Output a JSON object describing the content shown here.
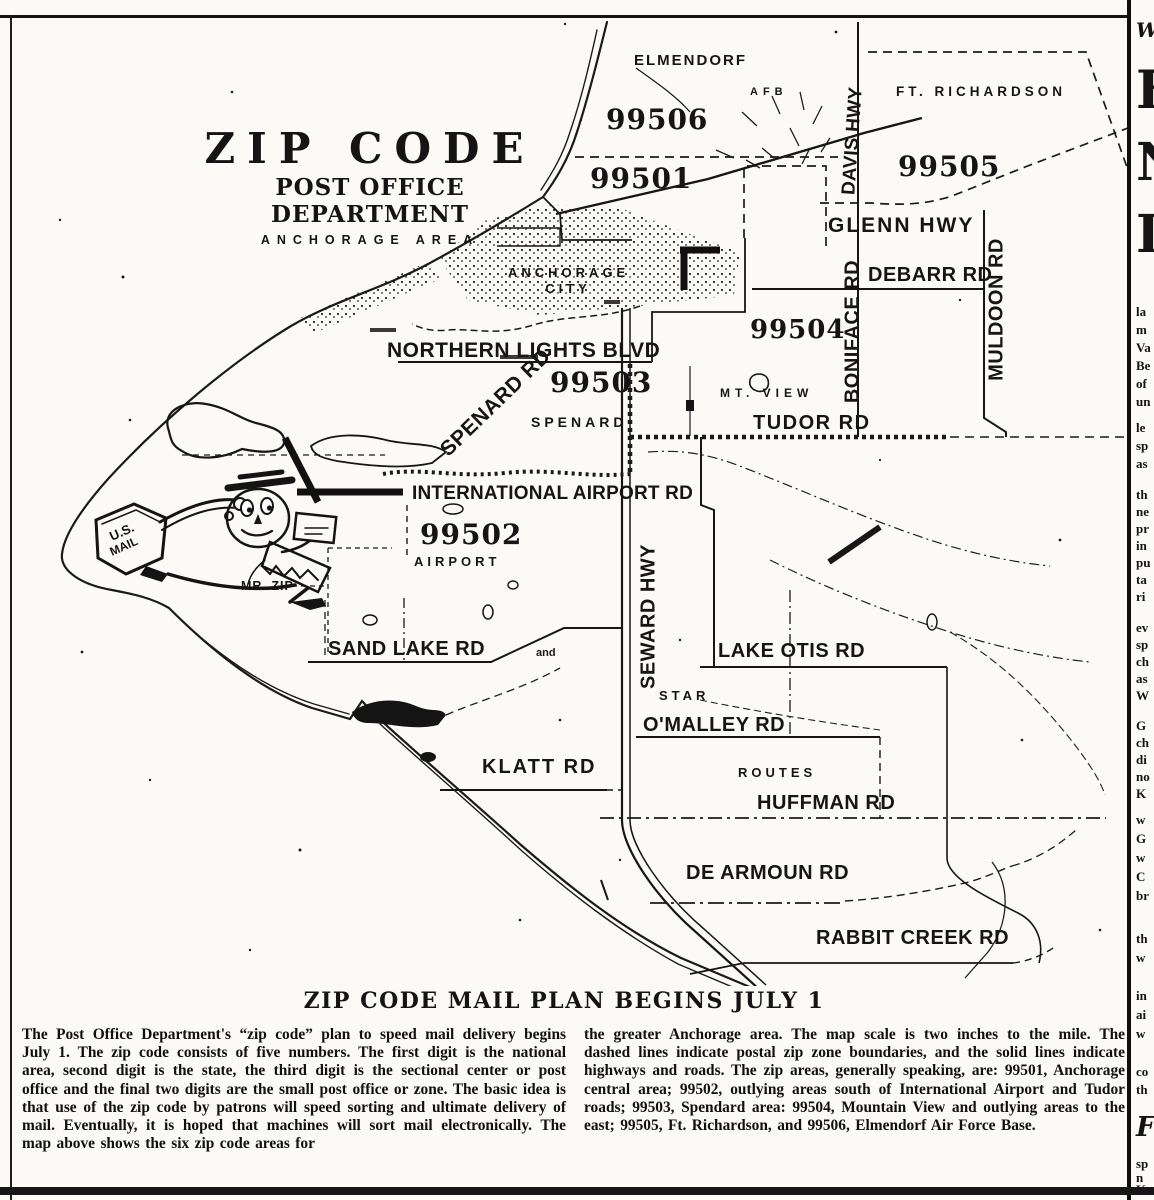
{
  "map": {
    "title": {
      "line1": "ZIP CODE",
      "line2": "POST OFFICE DEPARTMENT",
      "line3": "ANCHORAGE AREA"
    },
    "zips": {
      "z99506": "99506",
      "z99501": "99501",
      "z99505": "99505",
      "z99504": "99504",
      "z99503": "99503",
      "z99502": "99502"
    },
    "labels": {
      "elmendorf": "ELMENDORF",
      "afb": "AFB",
      "ft_richardson": "FT. RICHARDSON",
      "davis_hwy": "DAVIS HWY",
      "glenn_hwy": "GLENN HWY",
      "anchorage_city_line1": "ANCHORAGE",
      "anchorage_city_line2": "CITY",
      "debarr_rd": "DEBARR RD",
      "muldoon_rd": "MULDOON RD",
      "boniface_rd": "BONIFACE RD",
      "mt_view": "MT. VIEW",
      "northern_lights_blvd": "NORTHERN LIGHTS BLVD",
      "spenard_rd": "SPENARD RD",
      "spenard": "SPENARD",
      "tudor_rd": "TUDOR RD",
      "international_airport_rd": "INTERNATIONAL AIRPORT RD",
      "airport": "AIRPORT",
      "mr_zip": "MR. ZIP",
      "us_mail_line1": "U.S.",
      "us_mail_line2": "MAIL",
      "sand_lake_rd": "SAND LAKE RD",
      "and_connector": "and",
      "seward_hwy": "SEWARD HWY",
      "lake_otis_rd": "LAKE OTIS RD",
      "star": "STAR",
      "omalley_rd": "O'MALLEY RD",
      "klatt_rd": "KLATT RD",
      "routes": "ROUTES",
      "huffman_rd": "HUFFMAN RD",
      "de_armoun_rd": "DE ARMOUN RD",
      "rabbit_creek_rd": "RABBIT CREEK RD"
    }
  },
  "caption": {
    "heading": "ZIP CODE MAIL PLAN BEGINS JULY 1",
    "left_column": "The Post Office Department's “zip code” plan to speed mail delivery begins July 1. The zip code consists of five numbers. The first digit is the national area, second digit is the state, the third digit is the sectional center or post office and the final two digits are the small post office or zone. The basic idea is that use of the zip code by patrons will speed sorting and ultimate delivery of mail. Eventually, it is hoped that machines will sort mail electronically. The map above shows the six zip code areas for",
    "right_column": "the greater Anchorage area. The map scale is two inches to the mile. The dashed lines indicate postal zip zone boundaries, and the solid lines indicate highways and roads. The zip areas, generally speaking, are: 99501, Anchorage central area; 99502, outlying areas south of International Airport and Tudor roads; 99503, Spendard area: 99504, Mountain View and outlying areas to the east; 99505, Ft. Richardson, and 99506, Elmendorf Air Force Base."
  },
  "adjacent_column": {
    "fragments": [
      {
        "t": "W",
        "y": 18,
        "cls": "frag-w"
      },
      {
        "t": "F",
        "y": 60,
        "cls": "frag-big"
      },
      {
        "t": "N",
        "y": 132,
        "cls": "frag-big"
      },
      {
        "t": "I",
        "y": 204,
        "cls": "frag-big"
      },
      {
        "t": "la",
        "y": 304
      },
      {
        "t": "m",
        "y": 322
      },
      {
        "t": "Va",
        "y": 340
      },
      {
        "t": "Be",
        "y": 358
      },
      {
        "t": "of",
        "y": 376
      },
      {
        "t": "un",
        "y": 394
      },
      {
        "t": "le",
        "y": 420
      },
      {
        "t": "sp",
        "y": 438
      },
      {
        "t": "as",
        "y": 456
      },
      {
        "t": "th",
        "y": 487
      },
      {
        "t": "ne",
        "y": 504
      },
      {
        "t": "pr",
        "y": 521
      },
      {
        "t": "in",
        "y": 538
      },
      {
        "t": "pu",
        "y": 555
      },
      {
        "t": "ta",
        "y": 572
      },
      {
        "t": "ri",
        "y": 589
      },
      {
        "t": "ev",
        "y": 620
      },
      {
        "t": "sp",
        "y": 637
      },
      {
        "t": "ch",
        "y": 654
      },
      {
        "t": "as",
        "y": 671
      },
      {
        "t": "W",
        "y": 688
      },
      {
        "t": "G",
        "y": 718
      },
      {
        "t": "ch",
        "y": 735
      },
      {
        "t": "di",
        "y": 752
      },
      {
        "t": "no",
        "y": 769
      },
      {
        "t": "K",
        "y": 786
      },
      {
        "t": "w",
        "y": 812
      },
      {
        "t": "G",
        "y": 831
      },
      {
        "t": "w",
        "y": 850
      },
      {
        "t": "C",
        "y": 869
      },
      {
        "t": "br",
        "y": 888
      },
      {
        "t": "th",
        "y": 931
      },
      {
        "t": "w",
        "y": 950
      },
      {
        "t": "in",
        "y": 988
      },
      {
        "t": "ai",
        "y": 1007
      },
      {
        "t": "w",
        "y": 1026
      },
      {
        "t": "co",
        "y": 1064
      },
      {
        "t": "th",
        "y": 1082
      },
      {
        "t": "F",
        "y": 1112,
        "cls": "frag-italic"
      },
      {
        "t": "sp",
        "y": 1156
      },
      {
        "t": "n",
        "y": 1170
      },
      {
        "t": "K",
        "y": 1182
      }
    ]
  },
  "left_margin": {
    "fragments": [
      {
        "t": "·",
        "y": 318
      },
      {
        "t": "t",
        "y": 378
      },
      {
        "t": "-",
        "y": 402
      },
      {
        "t": "e",
        "y": 426
      },
      {
        "t": "-",
        "y": 450
      },
      {
        "t": "s",
        "y": 474
      },
      {
        "t": "-",
        "y": 498
      },
      {
        "t": "a",
        "y": 522
      },
      {
        "t": "e",
        "y": 546
      },
      {
        "t": "-",
        "y": 570
      },
      {
        "t": "d",
        "y": 594
      },
      {
        "t": "-",
        "y": 628
      },
      {
        "t": "r",
        "y": 652
      },
      {
        "t": "-",
        "y": 680
      },
      {
        "t": "l",
        "y": 708
      },
      {
        "t": "t",
        "y": 740
      },
      {
        "t": "-",
        "y": 780
      },
      {
        "t": "e",
        "y": 812
      },
      {
        "t": "s",
        "y": 844
      },
      {
        "t": "-",
        "y": 880
      },
      {
        "t": "n",
        "y": 916
      },
      {
        "t": "e",
        "y": 948
      },
      {
        "t": "-",
        "y": 980
      },
      {
        "t": "t",
        "y": 1020
      },
      {
        "t": "r",
        "y": 1060
      },
      {
        "t": "e",
        "y": 1100
      },
      {
        "t": "s",
        "y": 1135
      }
    ]
  },
  "colors": {
    "ink": "#141414",
    "paper": "#fbfaf6"
  }
}
